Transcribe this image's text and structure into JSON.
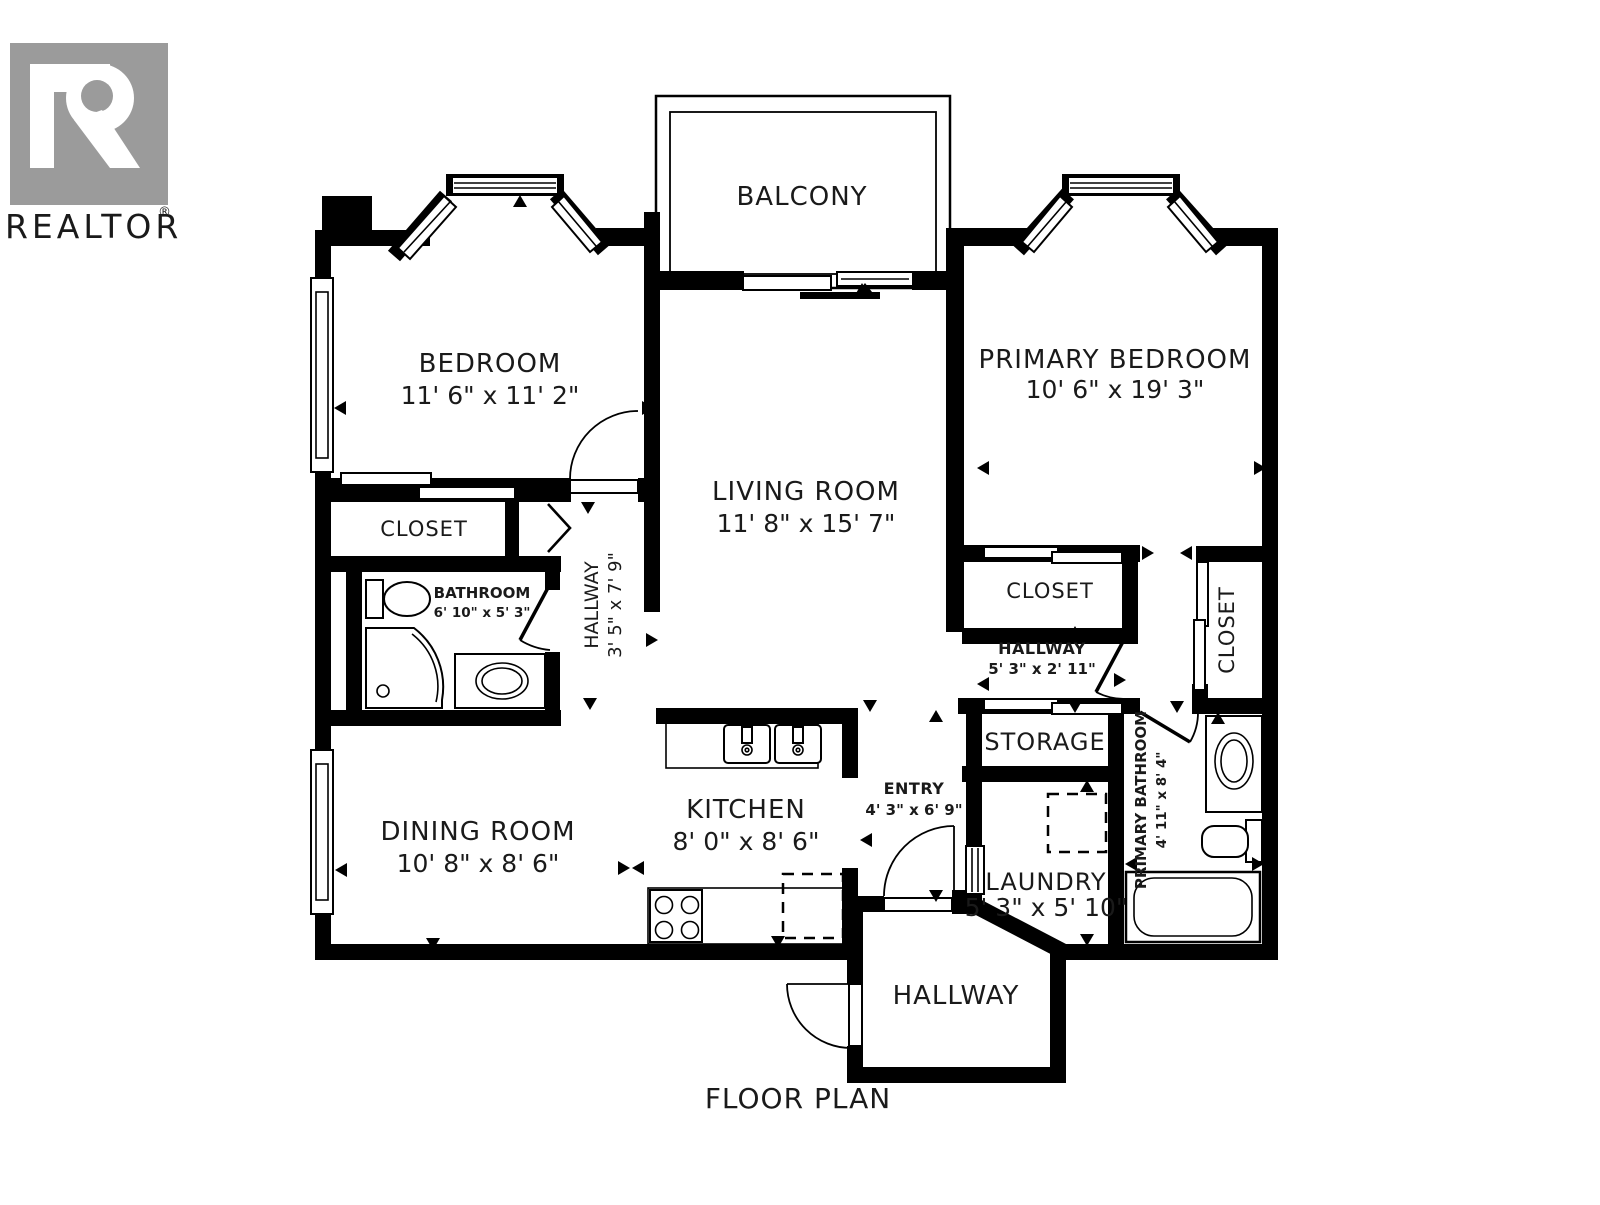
{
  "title": "FLOOR PLAN",
  "branding": {
    "logo_letter": "R",
    "logo_text": "REALTOR",
    "registered_mark": "®"
  },
  "rooms": [
    {
      "id": "balcony",
      "name": "BALCONY",
      "dims": ""
    },
    {
      "id": "bedroom",
      "name": "BEDROOM",
      "dims": "11' 6\" x 11' 2\""
    },
    {
      "id": "primary-bedroom",
      "name": "PRIMARY BEDROOM",
      "dims": "10' 6\" x 19' 3\""
    },
    {
      "id": "living-room",
      "name": "LIVING ROOM",
      "dims": "11' 8\" x 15' 7\""
    },
    {
      "id": "closet-bedroom",
      "name": "CLOSET",
      "dims": ""
    },
    {
      "id": "bathroom",
      "name": "BATHROOM",
      "dims": "6' 10\" x 5' 3\""
    },
    {
      "id": "hallway-main",
      "name": "HALLWAY",
      "dims": "3' 5\" x 7' 9\""
    },
    {
      "id": "closet-primary",
      "name": "CLOSET",
      "dims": ""
    },
    {
      "id": "hallway-primary",
      "name": "HALLWAY",
      "dims": "5' 3\" x 2' 11\""
    },
    {
      "id": "closet-primary-2",
      "name": "CLOSET",
      "dims": ""
    },
    {
      "id": "storage",
      "name": "STORAGE",
      "dims": ""
    },
    {
      "id": "primary-bathroom",
      "name": "PRIMARY BATHROOM",
      "dims": "4' 11\" x 8' 4\""
    },
    {
      "id": "dining-room",
      "name": "DINING ROOM",
      "dims": "10' 8\" x 8' 6\""
    },
    {
      "id": "kitchen",
      "name": "KITCHEN",
      "dims": "8' 0\" x 8' 6\""
    },
    {
      "id": "entry",
      "name": "ENTRY",
      "dims": "4' 3\" x 6' 9\""
    },
    {
      "id": "laundry",
      "name": "LAUNDRY",
      "dims": "5' 3\" x 5' 10\""
    },
    {
      "id": "hallway-entrance",
      "name": "HALLWAY",
      "dims": ""
    }
  ],
  "colors": {
    "walls": "#000000",
    "background": "#ffffff",
    "logo_gray": "#9b9b9b"
  }
}
